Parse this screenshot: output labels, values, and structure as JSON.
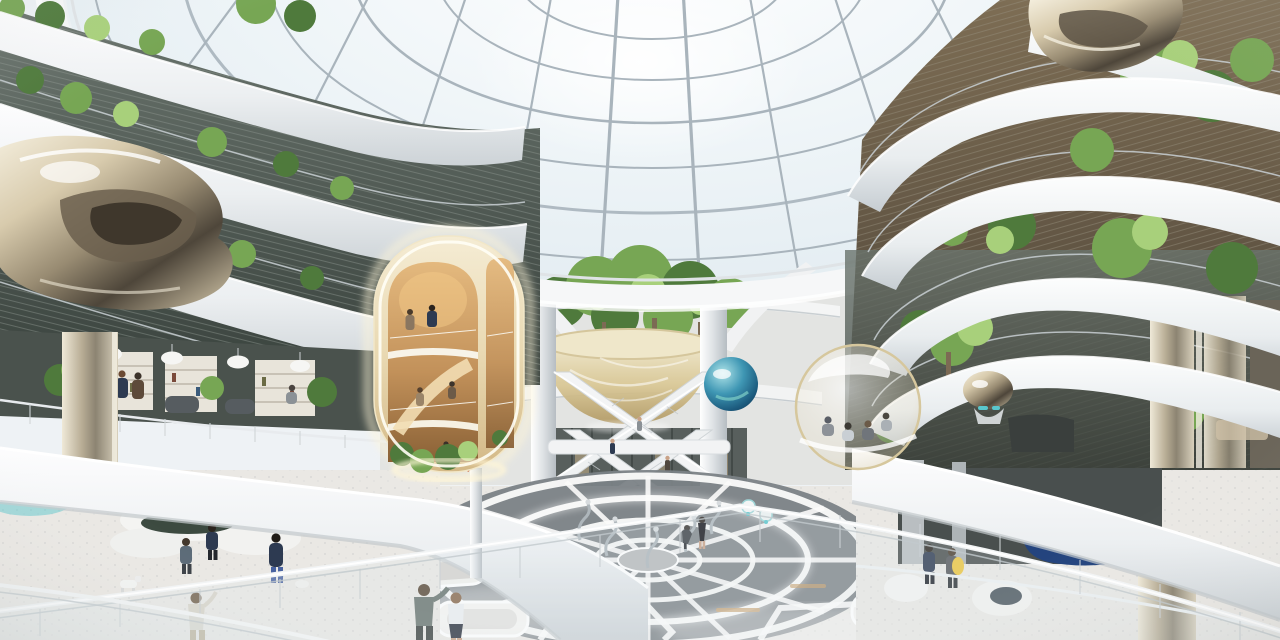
{
  "meta": {
    "type": "architectural-interior-rendering",
    "width": 1280,
    "height": 640
  },
  "scene": {
    "setting": "Futuristic circular atrium under a ribbed glass dome: stacked white curved balconies with trees, a glowing golden capsule pavilion, a translucent golden bowl sculpture, chrome blob artworks, criss-crossing escalators, an illuminated web-patterned plaza floor and scattered visitors",
    "elements": [
      {
        "name": "glass-dome"
      },
      {
        "name": "dome-oculus-ring"
      },
      {
        "name": "balcony-levels-left"
      },
      {
        "name": "balcony-levels-right"
      },
      {
        "name": "hanging-gardens"
      },
      {
        "name": "golden-capsule-pavilion"
      },
      {
        "name": "golden-bowl-sculpture"
      },
      {
        "name": "blue-glass-sphere"
      },
      {
        "name": "glass-bubble-lounge"
      },
      {
        "name": "chrome-blob-sculpture-left"
      },
      {
        "name": "chrome-blob-sculpture-right"
      },
      {
        "name": "criss-cross-escalators"
      },
      {
        "name": "atrium-garden-terrace"
      },
      {
        "name": "library-lounge-level"
      },
      {
        "name": "illuminated-floor-web"
      },
      {
        "name": "silver-dancer-sculptures"
      },
      {
        "name": "white-lounge-sculptures"
      },
      {
        "name": "robot-dog"
      },
      {
        "name": "blue-artwork"
      },
      {
        "name": "foreground-glass-railing"
      },
      {
        "name": "visitors"
      }
    ]
  },
  "colors": {
    "bg": "#eef2f5",
    "glass": "#e7eef3",
    "glass-bright": "#fdfeff",
    "mullion": "#a9b4bc",
    "white": "#f6f7f8",
    "band-shade": "#d5dade",
    "band-deep": "#bcc3c8",
    "recess": "#57605a",
    "recess-dark": "#3a423d",
    "recess-brown": "#73644e",
    "green": "#77a654",
    "green-dark": "#4f7a3c",
    "green-light": "#a8d07b",
    "trunk": "#7c6a54",
    "gold-shell": "#ecdfbd",
    "gold-glow": "#fff6d8",
    "gold-inner": "#cf9f63",
    "gold-deep": "#9a6e3c",
    "bowl": "#d9c794",
    "bowl-light": "#f1e9cf",
    "chrome": "#d7cbae",
    "chrome-dark": "#564e41",
    "blue-sphere": "#2f80a6",
    "teal": "#59c6cc",
    "floor": "#eae8e4",
    "floor-plate": "#7b8286",
    "wood": "#c79f6b",
    "navy": "#2d3a51",
    "grey-suit": "#8b9196",
    "skin": "#c9a287",
    "yellow": "#ecc63f",
    "rail": "#c9d0d4",
    "art-blue": "#2e55a0",
    "shelf": "#e8e4da",
    "chair": "#565c60"
  }
}
